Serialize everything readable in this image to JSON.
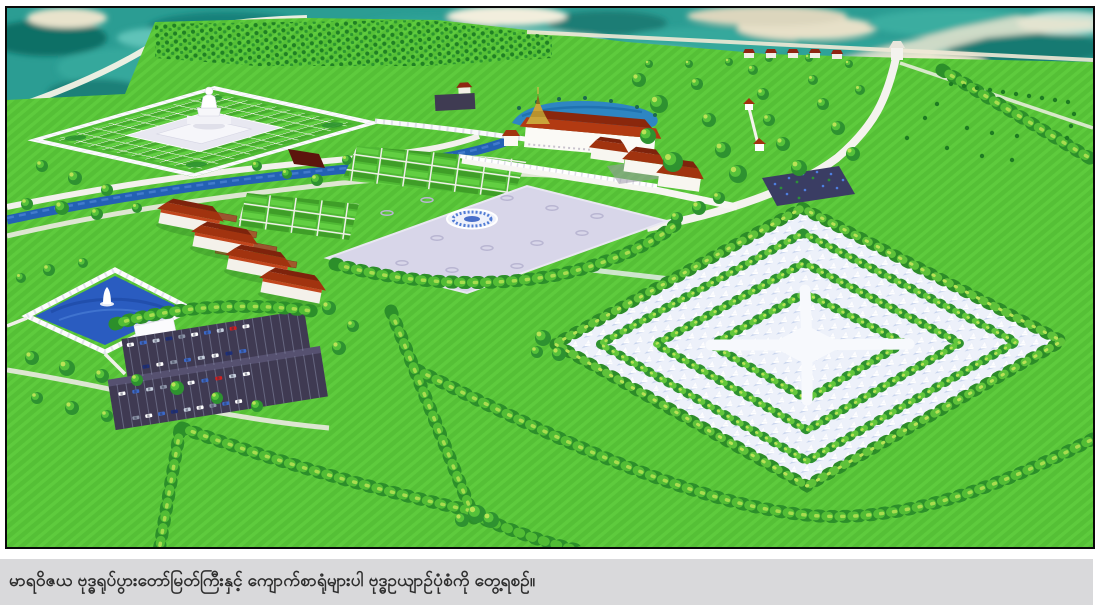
{
  "caption": {
    "text": "မာရဝိဇယ ဗုဒ္ဓရုပ်ပွားတော်မြတ်ကြီးနှင့် ကျောက်စာရုံများပါ ဗုဒ္ဓဥယျာဉ်ပုံစံကို တွေ့ရစဉ်။",
    "bar_color": "#d9d9db",
    "text_color": "#2d2d2d"
  },
  "photo": {
    "border_color": "#0a0a0a",
    "type": "3d-aerial-architectural-rendering",
    "elements": [
      "photographic-terrain-strip",
      "buddha-image-compound",
      "great-buddha-statue",
      "shrine-hall-with-gold-spire",
      "shrine-pond",
      "stone-inscription-stupa-field",
      "monastery-building-row",
      "square-pond-with-statue",
      "ceremonial-plaza-with-emblem",
      "parking-lots-with-cars",
      "canal",
      "tree-lined-avenues",
      "orchard-rows",
      "entrance-gate-road"
    ]
  },
  "scene": {
    "palette": {
      "lawn": "#55c036",
      "lawn_light": "#5ecb3d",
      "tree": "#2e9230",
      "tree_light": "#63c73c",
      "tree_highlight": "#b9e356",
      "terrain_teal": "#2b9d93",
      "terrain_cream": "#efe9d2",
      "water": "#2a5cc0",
      "water_teal": "#2e86c2",
      "canal": "#2361b4",
      "road": "#f2f1ec",
      "plaza": "#d8d6e9",
      "stupa_bg": "#edf1fa",
      "stupa_shadow": "#c5d2ec",
      "roof_red": "#a1330f",
      "roof_red_dark": "#7e230c",
      "roof_red_bright": "#c2451c",
      "gold": "#caa43a",
      "asphalt": "#3f3a52",
      "wall_white": "#fbfbfd"
    }
  }
}
